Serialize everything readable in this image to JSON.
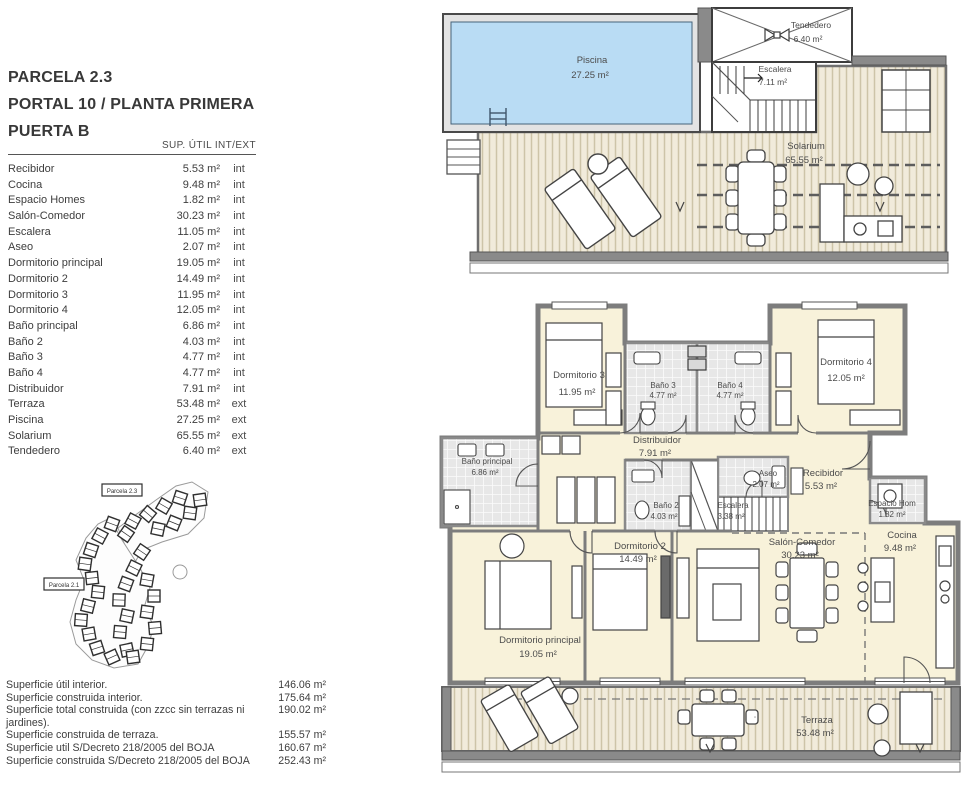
{
  "header": {
    "line1": "PARCELA 2.3",
    "line2": "PORTAL 10 / PLANTA PRIMERA",
    "line3": "PUERTA B"
  },
  "area_table": {
    "header": "SUP. ÚTIL INT/EXT",
    "rows": [
      {
        "name": "Recibidor",
        "area": "5.53 m²",
        "type": "int"
      },
      {
        "name": "Cocina",
        "area": "9.48 m²",
        "type": "int"
      },
      {
        "name": "Espacio Homes",
        "area": "1.82 m²",
        "type": "int"
      },
      {
        "name": "Salón-Comedor",
        "area": "30.23 m²",
        "type": "int"
      },
      {
        "name": "Escalera",
        "area": "11.05 m²",
        "type": "int"
      },
      {
        "name": "Aseo",
        "area": "2.07 m²",
        "type": "int"
      },
      {
        "name": "Dormitorio principal",
        "area": "19.05 m²",
        "type": "int"
      },
      {
        "name": "Dormitorio 2",
        "area": "14.49 m²",
        "type": "int"
      },
      {
        "name": "Dormitorio 3",
        "area": "11.95 m²",
        "type": "int"
      },
      {
        "name": "Dormitorio 4",
        "area": "12.05 m²",
        "type": "int"
      },
      {
        "name": "Baño principal",
        "area": "6.86 m²",
        "type": "int"
      },
      {
        "name": "Baño 2",
        "area": "4.03 m²",
        "type": "int"
      },
      {
        "name": "Baño 3",
        "area": "4.77 m²",
        "type": "int"
      },
      {
        "name": "Baño 4",
        "area": "4.77 m²",
        "type": "int"
      },
      {
        "name": "Distribuidor",
        "area": "7.91 m²",
        "type": "int"
      },
      {
        "name": "Terraza",
        "area": "53.48 m²",
        "type": "ext"
      },
      {
        "name": "Piscina",
        "area": "27.25 m²",
        "type": "ext"
      },
      {
        "name": "Solarium",
        "area": "65.55 m²",
        "type": "ext"
      },
      {
        "name": "Tendedero",
        "area": "6.40 m²",
        "type": "ext"
      }
    ]
  },
  "summary": {
    "rows": [
      {
        "label": "Superficie útil interior.",
        "value": "146.06 m²"
      },
      {
        "label": "Superficie construida interior.",
        "value": "175.64 m²"
      },
      {
        "label": "Superficie total construida (con zzcc sin terrazas ni jardines).",
        "value": "190.02 m²"
      },
      {
        "label": "Superficie construida de terraza.",
        "value": "155.57 m²"
      },
      {
        "label": "Superficie util S/Decreto 218/2005 del BOJA",
        "value": "160.67 m²"
      },
      {
        "label": "Superficie construida S/Decreto 218/2005 del BOJA",
        "value": "252.43 m²"
      }
    ]
  },
  "roof_plan": {
    "piscina": {
      "name": "Piscina",
      "area": "27.25 m²"
    },
    "tendedero": {
      "name": "Tendedero",
      "area": "6.40 m²"
    },
    "escalera": {
      "name": "Escalera",
      "area": "7.11 m²"
    },
    "solarium": {
      "name": "Solarium",
      "area": "65.55 m²"
    }
  },
  "floor_plan": {
    "dormitorio3": {
      "name": "Dormitorio 3",
      "area": "11.95 m²"
    },
    "bano3": {
      "name": "Baño 3",
      "area": "4.77 m²"
    },
    "bano4": {
      "name": "Baño 4",
      "area": "4.77 m²"
    },
    "dormitorio4": {
      "name": "Dormitorio 4",
      "area": "12.05 m²"
    },
    "distribuidor": {
      "name": "Distribuidor",
      "area": "7.91 m²"
    },
    "bano_principal": {
      "name": "Baño principal",
      "area": "6.86 m²"
    },
    "bano2": {
      "name": "Baño 2",
      "area": "4.03 m²"
    },
    "escalera": {
      "name": "Escalera",
      "area": "3.38 m²"
    },
    "aseo": {
      "name": "Aseo",
      "area": "2.07 m²"
    },
    "recibidor": {
      "name": "Recibidor",
      "area": "5.53 m²"
    },
    "espacio_homes": {
      "name": "Espacio Hom",
      "area": "1.82 m²"
    },
    "cocina": {
      "name": "Cocina",
      "area": "9.48 m²"
    },
    "salon_comedor": {
      "name": "Salón-Comedor",
      "area": "30.23 m²"
    },
    "dormitorio2": {
      "name": "Dormitorio 2",
      "area": "14.49 m²"
    },
    "dormitorio_principal": {
      "name": "Dormitorio principal",
      "area": "19.05 m²"
    },
    "terraza": {
      "name": "Terraza",
      "area": "53.48 m²"
    }
  },
  "site_plan": {
    "tag_top": "Parcela 2.3",
    "tag_left": "Parcela 2.1"
  },
  "colors": {
    "pool": "#b9dcf4",
    "room": "#f8f2da",
    "wall": "#8a8a8a",
    "deck_bg": "#f1ebdb",
    "deck_stripe": "#cdc4a8",
    "tile": "#e7e7e7",
    "text": "#4c4c4c"
  }
}
